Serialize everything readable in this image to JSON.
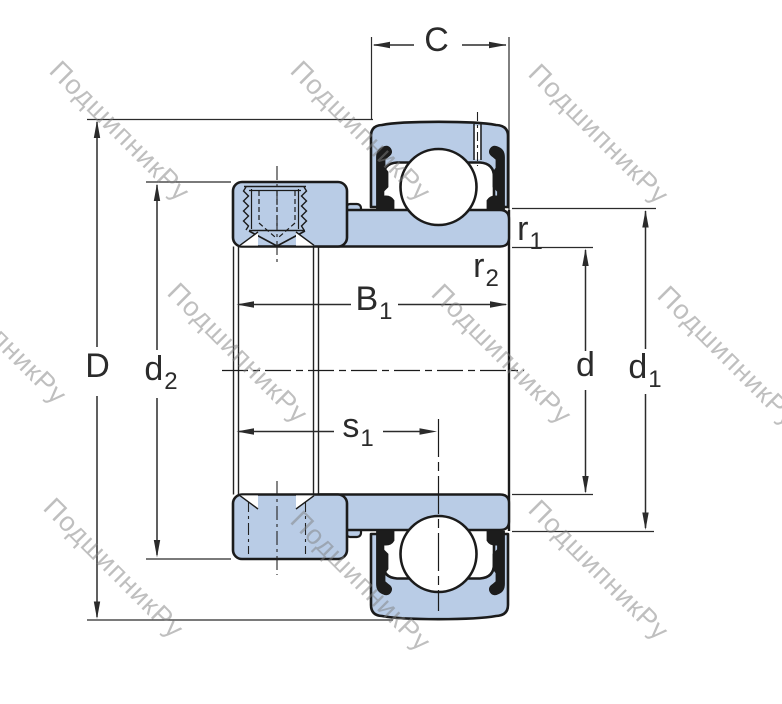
{
  "watermark": {
    "text": "ПодшипникРу"
  },
  "dimensions": {
    "C": {
      "main": "C",
      "sub": ""
    },
    "D": {
      "main": "D",
      "sub": ""
    },
    "d2": {
      "main": "d",
      "sub": "2"
    },
    "B1": {
      "main": "B",
      "sub": "1"
    },
    "s1": {
      "main": "s",
      "sub": "1"
    },
    "r1": {
      "main": "r",
      "sub": "1"
    },
    "r2": {
      "main": "r",
      "sub": "2"
    },
    "d": {
      "main": "d",
      "sub": ""
    },
    "d1": {
      "main": "d",
      "sub": "1"
    }
  },
  "colors": {
    "part_fill": "#b9cce6",
    "outline": "#1b1b1b",
    "dimension": "#2b2b2b",
    "watermark": "#969696"
  }
}
